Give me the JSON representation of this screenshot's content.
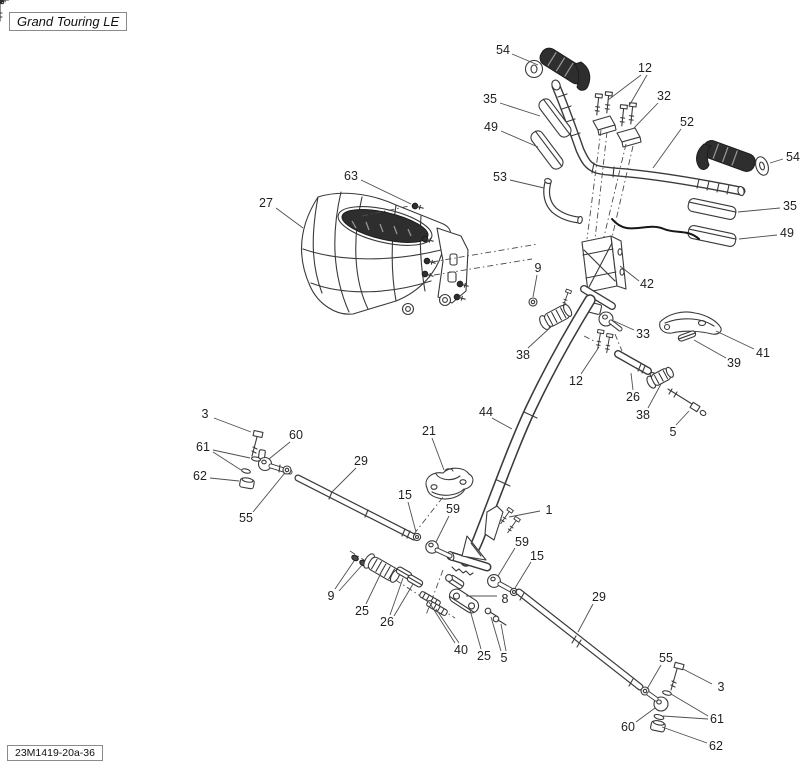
{
  "title_box": {
    "text": "Grand Touring LE"
  },
  "part_code_box": {
    "text": "23M1419-20a-36"
  },
  "colors": {
    "line": "#3a3a3a",
    "dark_fill": "#2e2e2e",
    "leader": "#4f4f4f",
    "background": "#ffffff"
  },
  "diagram": {
    "type": "exploded-parts-diagram",
    "subject": "steering system",
    "callouts": [
      {
        "label": "54",
        "x": 503,
        "y": 50,
        "leaders": [
          [
            512,
            54,
            538,
            65
          ]
        ]
      },
      {
        "label": "12",
        "x": 645,
        "y": 68,
        "leaders": [
          [
            641,
            75,
            608,
            100
          ],
          [
            647,
            75,
            629,
            106
          ]
        ]
      },
      {
        "label": "32",
        "x": 664,
        "y": 96,
        "leaders": [
          [
            658,
            103,
            633,
            129
          ]
        ]
      },
      {
        "label": "35",
        "x": 490,
        "y": 99,
        "leaders": [
          [
            500,
            103,
            540,
            116
          ]
        ]
      },
      {
        "label": "49",
        "x": 491,
        "y": 127,
        "leaders": [
          [
            501,
            131,
            538,
            147
          ]
        ]
      },
      {
        "label": "52",
        "x": 687,
        "y": 122,
        "leaders": [
          [
            681,
            129,
            653,
            168
          ]
        ]
      },
      {
        "label": "53",
        "x": 500,
        "y": 177,
        "leaders": [
          [
            510,
            180,
            544,
            188
          ]
        ]
      },
      {
        "label": "54",
        "x": 793,
        "y": 157,
        "leaders": [
          [
            783,
            159,
            770,
            163
          ]
        ]
      },
      {
        "label": "35",
        "x": 790,
        "y": 206,
        "leaders": [
          [
            780,
            208,
            738,
            212
          ]
        ]
      },
      {
        "label": "49",
        "x": 787,
        "y": 233,
        "leaders": [
          [
            777,
            235,
            739,
            239
          ]
        ]
      },
      {
        "label": "63",
        "x": 351,
        "y": 176,
        "leaders": [
          [
            361,
            180,
            411,
            204
          ]
        ]
      },
      {
        "label": "27",
        "x": 266,
        "y": 203,
        "leaders": [
          [
            276,
            208,
            303,
            228
          ]
        ]
      },
      {
        "label": "42",
        "x": 647,
        "y": 284,
        "leaders": [
          [
            639,
            281,
            620,
            266
          ]
        ]
      },
      {
        "label": "9",
        "x": 538,
        "y": 268,
        "leaders": [
          [
            537,
            275,
            533,
            297
          ]
        ]
      },
      {
        "label": "33",
        "x": 643,
        "y": 334,
        "leaders": [
          [
            634,
            330,
            614,
            321
          ]
        ]
      },
      {
        "label": "41",
        "x": 763,
        "y": 353,
        "leaders": [
          [
            754,
            349,
            716,
            331
          ]
        ]
      },
      {
        "label": "39",
        "x": 734,
        "y": 363,
        "leaders": [
          [
            726,
            358,
            694,
            340
          ]
        ]
      },
      {
        "label": "38",
        "x": 523,
        "y": 355,
        "leaders": [
          [
            528,
            348,
            553,
            325
          ]
        ]
      },
      {
        "label": "12",
        "x": 576,
        "y": 381,
        "leaders": [
          [
            581,
            374,
            599,
            347
          ]
        ]
      },
      {
        "label": "26",
        "x": 633,
        "y": 397,
        "leaders": [
          [
            633,
            390,
            631,
            373
          ]
        ]
      },
      {
        "label": "38",
        "x": 643,
        "y": 415,
        "leaders": [
          [
            648,
            408,
            661,
            384
          ]
        ]
      },
      {
        "label": "5",
        "x": 673,
        "y": 432,
        "leaders": [
          [
            676,
            425,
            689,
            411
          ]
        ]
      },
      {
        "label": "44",
        "x": 486,
        "y": 412,
        "leaders": [
          [
            492,
            418,
            512,
            429
          ]
        ]
      },
      {
        "label": "21",
        "x": 429,
        "y": 431,
        "leaders": [
          [
            432,
            438,
            444,
            470
          ]
        ]
      },
      {
        "label": "3",
        "x": 205,
        "y": 414,
        "leaders": [
          [
            214,
            418,
            251,
            432
          ]
        ]
      },
      {
        "label": "60",
        "x": 296,
        "y": 435,
        "leaders": [
          [
            290,
            442,
            269,
            459
          ]
        ]
      },
      {
        "label": "61",
        "x": 203,
        "y": 447,
        "leaders": [
          [
            213,
            450,
            250,
            458
          ],
          [
            213,
            452,
            241,
            470
          ]
        ]
      },
      {
        "label": "62",
        "x": 200,
        "y": 476,
        "leaders": [
          [
            210,
            478,
            239,
            481
          ]
        ]
      },
      {
        "label": "55",
        "x": 246,
        "y": 518,
        "leaders": [
          [
            253,
            512,
            284,
            474
          ]
        ]
      },
      {
        "label": "29",
        "x": 361,
        "y": 461,
        "leaders": [
          [
            356,
            468,
            331,
            493
          ]
        ]
      },
      {
        "label": "15",
        "x": 405,
        "y": 495,
        "leaders": [
          [
            408,
            502,
            416,
            532
          ]
        ]
      },
      {
        "label": "59",
        "x": 453,
        "y": 509,
        "leaders": [
          [
            449,
            516,
            436,
            542
          ]
        ]
      },
      {
        "label": "1",
        "x": 549,
        "y": 510,
        "leaders": [
          [
            540,
            511,
            509,
            517
          ]
        ]
      },
      {
        "label": "59",
        "x": 522,
        "y": 542,
        "leaders": [
          [
            515,
            548,
            498,
            576
          ]
        ]
      },
      {
        "label": "15",
        "x": 537,
        "y": 556,
        "leaders": [
          [
            531,
            562,
            515,
            588
          ]
        ]
      },
      {
        "label": "8",
        "x": 505,
        "y": 599,
        "leaders": [
          [
            497,
            596,
            466,
            596
          ]
        ]
      },
      {
        "label": "29",
        "x": 599,
        "y": 597,
        "leaders": [
          [
            593,
            604,
            578,
            632
          ]
        ]
      },
      {
        "label": "9",
        "x": 331,
        "y": 596,
        "leaders": [
          [
            335,
            589,
            354,
            561
          ],
          [
            339,
            591,
            363,
            564
          ]
        ]
      },
      {
        "label": "25",
        "x": 362,
        "y": 611,
        "leaders": [
          [
            366,
            604,
            381,
            573
          ]
        ]
      },
      {
        "label": "26",
        "x": 387,
        "y": 622,
        "leaders": [
          [
            390,
            615,
            403,
            578
          ],
          [
            394,
            616,
            413,
            584
          ]
        ]
      },
      {
        "label": "40",
        "x": 461,
        "y": 650,
        "leaders": [
          [
            455,
            643,
            429,
            602
          ],
          [
            459,
            643,
            436,
            609
          ]
        ]
      },
      {
        "label": "25",
        "x": 484,
        "y": 656,
        "leaders": [
          [
            481,
            649,
            470,
            610
          ]
        ]
      },
      {
        "label": "5",
        "x": 504,
        "y": 658,
        "leaders": [
          [
            501,
            651,
            491,
            617
          ],
          [
            506,
            651,
            501,
            624
          ]
        ]
      },
      {
        "label": "55",
        "x": 666,
        "y": 658,
        "leaders": [
          [
            661,
            665,
            647,
            689
          ]
        ]
      },
      {
        "label": "3",
        "x": 721,
        "y": 687,
        "leaders": [
          [
            712,
            684,
            683,
            669
          ]
        ]
      },
      {
        "label": "61",
        "x": 717,
        "y": 719,
        "leaders": [
          [
            708,
            716,
            671,
            694
          ],
          [
            708,
            719,
            663,
            716
          ]
        ]
      },
      {
        "label": "60",
        "x": 628,
        "y": 727,
        "leaders": [
          [
            636,
            722,
            655,
            708
          ]
        ]
      },
      {
        "label": "62",
        "x": 716,
        "y": 746,
        "leaders": [
          [
            707,
            743,
            662,
            727
          ]
        ]
      }
    ]
  }
}
